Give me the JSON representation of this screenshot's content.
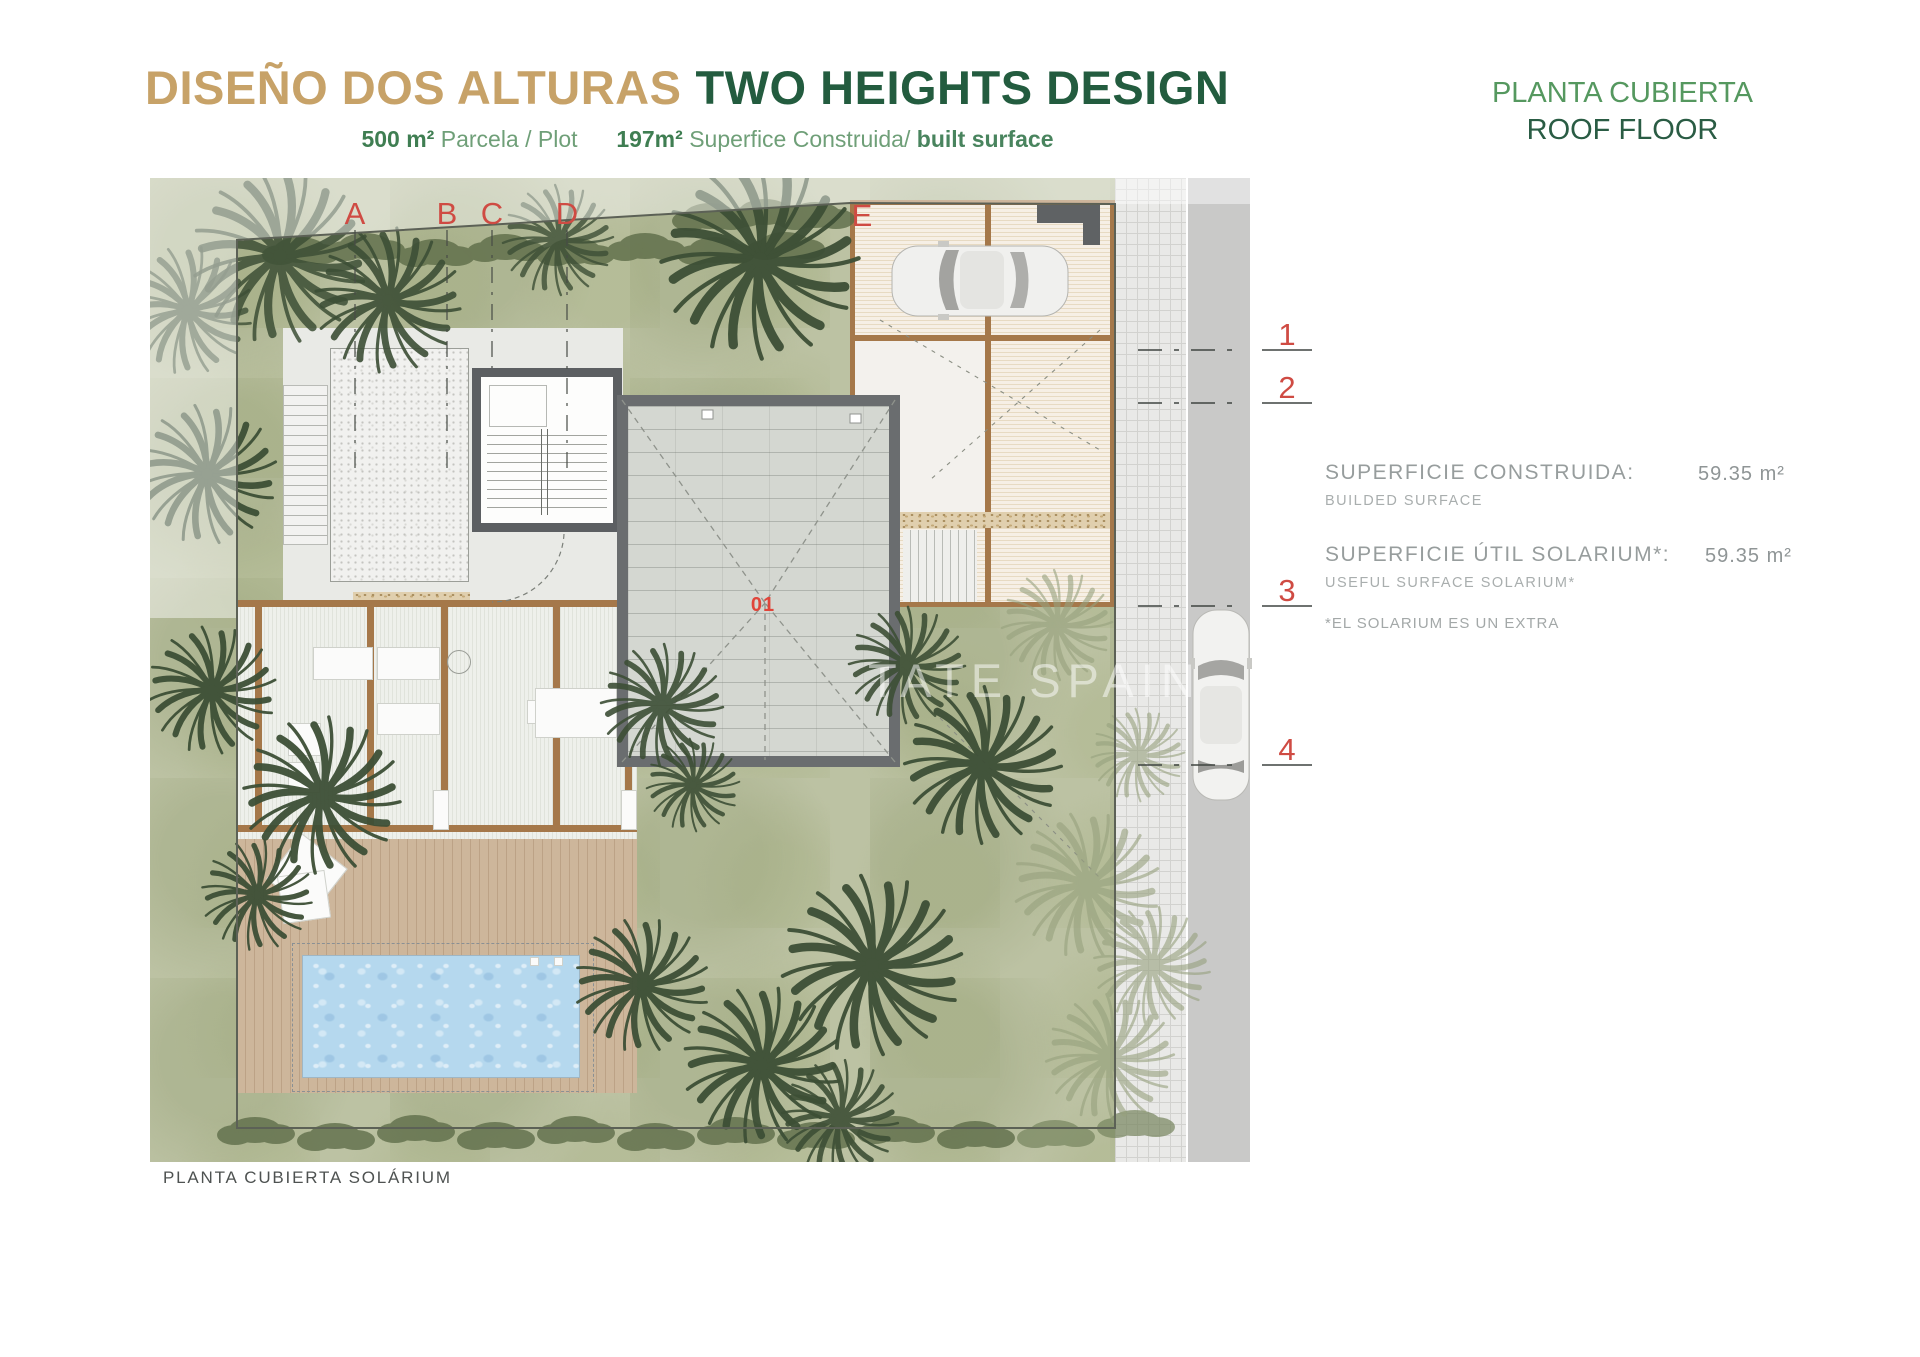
{
  "header": {
    "title_primary": "DISEÑO DOS ALTURAS",
    "title_secondary": "TWO HEIGHTS DESIGN",
    "plot_value": "500 m²",
    "plot_label": "Parcela / Plot",
    "built_value": "197m²",
    "built_label": "Superfice Construida/",
    "built_label_en": "built surface"
  },
  "floor_title": {
    "es": "PLANTA CUBIERTA",
    "en": "ROOF FLOOR"
  },
  "info_panel": {
    "rows": [
      {
        "label": "SUPERFICIE CONSTRUIDA:",
        "sublabel": "BUILDED SURFACE",
        "value": "59.35 m²"
      },
      {
        "label": "SUPERFICIE ÚTIL SOLARIUM*:",
        "sublabel": "USEFUL SURFACE SOLARIUM*",
        "value": "59.35 m²"
      }
    ],
    "note": "*EL SOLARIUM ES UN EXTRA"
  },
  "plan": {
    "caption": "PLANTA CUBIERTA SOLÁRIUM",
    "watermark": "TATE SPAIN",
    "unit_label": "01",
    "grid_letters": [
      "A",
      "B",
      "C",
      "D",
      "E"
    ],
    "grid_numbers": [
      "1",
      "2",
      "3",
      "4"
    ]
  },
  "colors": {
    "title_gold": "#C7A268",
    "title_green": "#235C3F",
    "subtitle_green": "#5B9468",
    "annotation_red": "#CF4B43",
    "garden_green": "#BCC2A4",
    "pool_blue": "#B5D8EE",
    "wood_brown": "#A5784A",
    "roof_gray": "#D4D7D1"
  }
}
